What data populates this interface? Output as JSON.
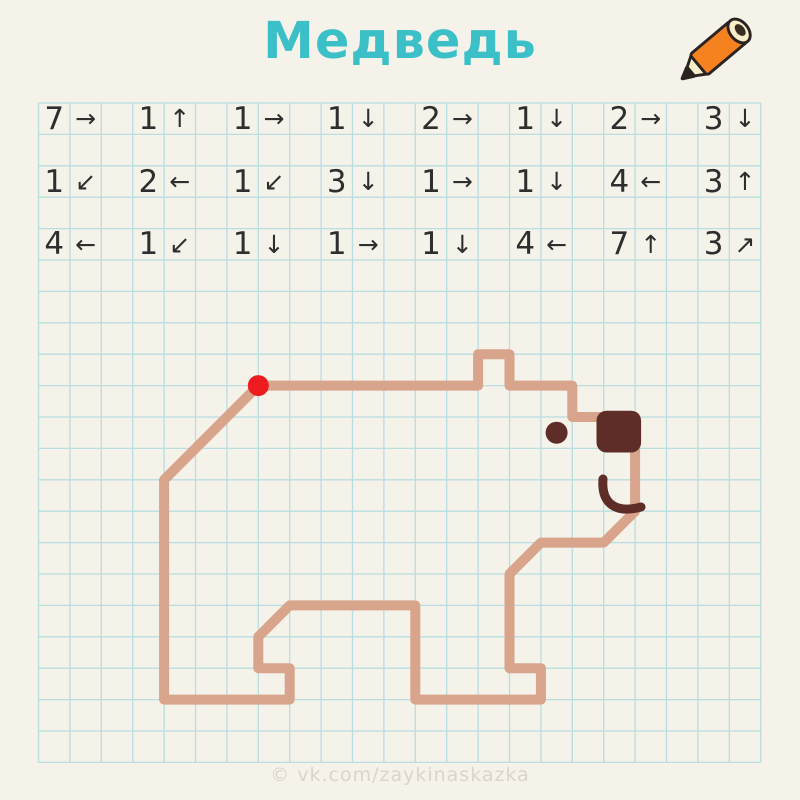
{
  "title": "Медведь",
  "watermark": "© vk.com/zaykinaskazka",
  "colors": {
    "background": "#f5f2ea",
    "grid_line": "#b9dde1",
    "figure_line": "#d8a48c",
    "figure_dark": "#5e2d28",
    "start_dot": "#ee1b1f",
    "title": "#3bc0c8",
    "instruction_text": "#2e2e2e",
    "watermark_text": "#d9d5c9",
    "pencil_body": "#f5821f",
    "pencil_cream": "#f8eecb",
    "pencil_outline": "#2b2320"
  },
  "grid": {
    "cols": 23,
    "rows": 21,
    "cell": 31.4,
    "origin_x": 38.5,
    "origin_y": 103
  },
  "instructions": {
    "rows": [
      {
        "items": [
          {
            "num": "7",
            "arrow": "→"
          },
          {
            "num": "1",
            "arrow": "↑"
          },
          {
            "num": "1",
            "arrow": "→"
          },
          {
            "num": "1",
            "arrow": "↓"
          },
          {
            "num": "2",
            "arrow": "→"
          },
          {
            "num": "1",
            "arrow": "↓"
          },
          {
            "num": "2",
            "arrow": "→"
          },
          {
            "num": "3",
            "arrow": "↓"
          }
        ]
      },
      {
        "items": [
          {
            "num": "1",
            "arrow": "↙"
          },
          {
            "num": "2",
            "arrow": "←"
          },
          {
            "num": "1",
            "arrow": "↙"
          },
          {
            "num": "3",
            "arrow": "↓"
          },
          {
            "num": "1",
            "arrow": "→"
          },
          {
            "num": "1",
            "arrow": "↓"
          },
          {
            "num": "4",
            "arrow": "←"
          },
          {
            "num": "3",
            "arrow": "↑"
          }
        ]
      },
      {
        "items": [
          {
            "num": "4",
            "arrow": "←"
          },
          {
            "num": "1",
            "arrow": "↙"
          },
          {
            "num": "1",
            "arrow": "↓"
          },
          {
            "num": "1",
            "arrow": "→"
          },
          {
            "num": "1",
            "arrow": "↓"
          },
          {
            "num": "4",
            "arrow": "←"
          },
          {
            "num": "7",
            "arrow": "↑"
          },
          {
            "num": "3",
            "arrow": "↗"
          }
        ]
      }
    ]
  },
  "figure": {
    "name": "bear",
    "start": {
      "col": 7,
      "row": 9
    },
    "stroke_width": 10,
    "start_dot_radius": 10.5,
    "face": {
      "eye": {
        "col": 16.5,
        "row": 10.5,
        "r": 11
      },
      "nose": {
        "col": 17.77,
        "row": 9.8,
        "w_cells": 1.42,
        "h_cells": 1.33,
        "corner_radius": 10
      },
      "mouth_path": "M 603 479 C 601 503 615 514 641 507",
      "mouth_stroke_width": 9
    }
  }
}
